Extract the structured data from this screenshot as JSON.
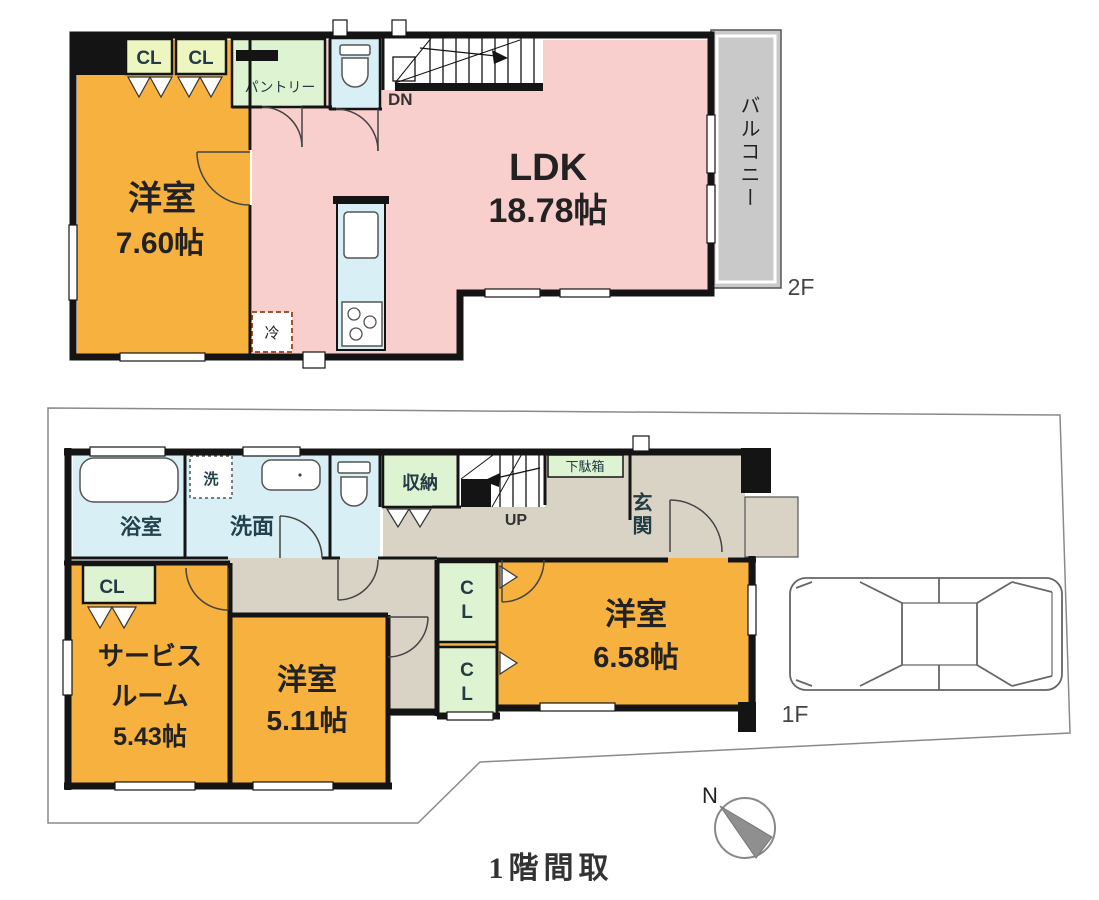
{
  "caption": "1階間取",
  "compass": {
    "north": "N"
  },
  "floor2": {
    "floor_label": "2F",
    "room_west": {
      "name": "洋室",
      "size": "7.60帖"
    },
    "ldk": {
      "name": "LDK",
      "size": "18.78帖"
    },
    "balcony": "バルコニー",
    "closet1": "CL",
    "closet2": "CL",
    "pantry": "パントリー",
    "stairs_down": "DN",
    "fridge": "冷"
  },
  "floor1": {
    "floor_label": "1F",
    "bathroom": "浴室",
    "washer": "洗",
    "washroom": "洗面",
    "storage": "収納",
    "stairs_up": "UP",
    "shoe_cabinet": "下駄箱",
    "entrance": "玄関",
    "closet_service": "CL",
    "closet_a": "CL",
    "closet_b": "CL",
    "service_room": {
      "name_line1": "サービス",
      "name_line2": "ルーム",
      "size": "5.43帖"
    },
    "room_center": {
      "name": "洋室",
      "size": "5.11帖"
    },
    "room_east": {
      "name": "洋室",
      "size": "6.58帖"
    }
  },
  "colors": {
    "room_orange": "#F6B13E",
    "ldk_pink": "#F9CFCD",
    "water_cyan": "#D9EFF6",
    "closet_green": "#DEF3D2",
    "closet_yellow_green": "#EDF5C0",
    "hallway_taupe": "#D8D3C5",
    "balcony_gray": "#C9C9C9",
    "wall_black": "#141414",
    "site_line_gray": "#8A8A8A",
    "compass_gray": "#8F8F8F",
    "fridge_dash_red": "#A6512F"
  }
}
